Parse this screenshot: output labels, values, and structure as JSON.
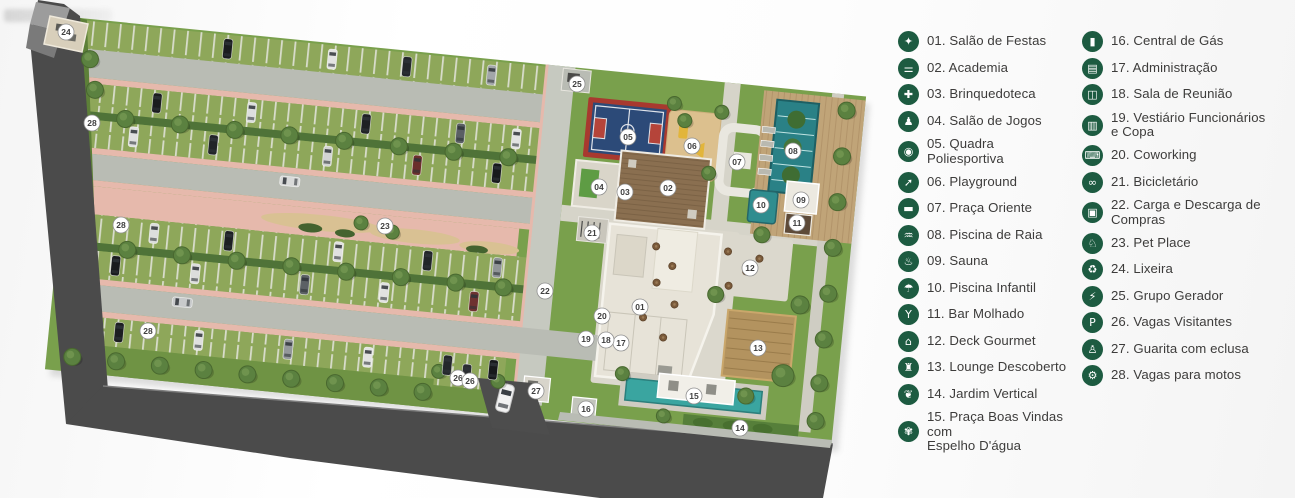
{
  "title": "Implantação / site plan with amenities legend",
  "colors": {
    "accent_green": "#1d5b41",
    "legend_text": "#3d3c3b",
    "grass": "#79a04c",
    "stall_green": "#8ea75a",
    "lane_gray": "#b9bcb4",
    "path_pink": "#e6b9ac",
    "road_dark": "#4b4b4b",
    "pool_teal": "#2a8186",
    "water_mirror_teal": "#3aa5a0",
    "court_blue": "#2c4a78",
    "court_red": "#a8392f",
    "sand": "#dcc08e",
    "wood_deck": "#c0a478",
    "roof_light": "#e7e3d8",
    "roof_wood": "#8a6f50"
  },
  "legend": {
    "columns": [
      {
        "items": [
          {
            "label": "01. Salão de Festas",
            "icon": "balloons",
            "glyph": "✦"
          },
          {
            "label": "02. Academia",
            "icon": "dumbbell",
            "glyph": "⚌"
          },
          {
            "label": "03. Brinquedoteca",
            "icon": "puzzle-piece",
            "glyph": "✚"
          },
          {
            "label": "04. Salão de Jogos",
            "icon": "game-controller",
            "glyph": "♟"
          },
          {
            "label": "05. Quadra Poliesportiva",
            "icon": "sports-court",
            "glyph": "◉"
          },
          {
            "label": "06. Playground",
            "icon": "slide",
            "glyph": "➚"
          },
          {
            "label": "07. Praça Oriente",
            "icon": "bench",
            "glyph": "▬"
          },
          {
            "label": "08. Piscina de Raia",
            "icon": "swimmer",
            "glyph": "♒"
          },
          {
            "label": "09. Sauna",
            "icon": "steam",
            "glyph": "♨"
          },
          {
            "label": "10. Piscina Infantil",
            "icon": "kids-pool",
            "glyph": "☂"
          },
          {
            "label": "11. Bar Molhado",
            "icon": "cocktail-glass",
            "glyph": "Y"
          },
          {
            "label": "12. Deck Gourmet",
            "icon": "house",
            "glyph": "⌂"
          },
          {
            "label": "13. Lounge Descoberto",
            "icon": "pergola",
            "glyph": "♜"
          },
          {
            "label": "14. Jardim Vertical",
            "icon": "plant",
            "glyph": "❦"
          },
          {
            "label": "15. Praça Boas Vindas com\nEspelho D'água",
            "icon": "fountain",
            "glyph": "✾"
          }
        ]
      },
      {
        "items": [
          {
            "label": "16. Central de Gás",
            "icon": "gas-cylinder",
            "glyph": "▮"
          },
          {
            "label": "17. Administração",
            "icon": "briefcase",
            "glyph": "▤"
          },
          {
            "label": "18. Sala de Reunião",
            "icon": "meeting-table",
            "glyph": "◫"
          },
          {
            "label": "19. Vestiário Funcionários\ne Copa",
            "icon": "lockers",
            "glyph": "▥"
          },
          {
            "label": "20. Coworking",
            "icon": "laptop",
            "glyph": "⌨"
          },
          {
            "label": "21. Bicicletário",
            "icon": "bicycle",
            "glyph": "∞"
          },
          {
            "label": "22. Carga e Descarga de Compras",
            "icon": "shopping-cart",
            "glyph": "▣"
          },
          {
            "label": "23. Pet Place",
            "icon": "dog",
            "glyph": "♘"
          },
          {
            "label": "24. Lixeira",
            "icon": "trash-bin",
            "glyph": "♻"
          },
          {
            "label": "25. Grupo Gerador",
            "icon": "generator",
            "glyph": "⚡"
          },
          {
            "label": "26. Vagas Visitantes",
            "icon": "car",
            "glyph": "P"
          },
          {
            "label": "27. Guarita com eclusa",
            "icon": "guard",
            "glyph": "♙"
          },
          {
            "label": "28. Vagas para motos",
            "icon": "motorcycle",
            "glyph": "⚙"
          }
        ]
      }
    ]
  },
  "plan": {
    "markers": [
      {
        "n": "01",
        "x": 640,
        "y": 307
      },
      {
        "n": "02",
        "x": 668,
        "y": 188
      },
      {
        "n": "03",
        "x": 625,
        "y": 192
      },
      {
        "n": "04",
        "x": 599,
        "y": 187
      },
      {
        "n": "05",
        "x": 628,
        "y": 137
      },
      {
        "n": "06",
        "x": 692,
        "y": 146
      },
      {
        "n": "07",
        "x": 737,
        "y": 162
      },
      {
        "n": "08",
        "x": 793,
        "y": 151
      },
      {
        "n": "09",
        "x": 801,
        "y": 200
      },
      {
        "n": "10",
        "x": 761,
        "y": 205
      },
      {
        "n": "11",
        "x": 797,
        "y": 223
      },
      {
        "n": "12",
        "x": 750,
        "y": 268
      },
      {
        "n": "13",
        "x": 758,
        "y": 348
      },
      {
        "n": "14",
        "x": 740,
        "y": 428
      },
      {
        "n": "15",
        "x": 694,
        "y": 396
      },
      {
        "n": "16",
        "x": 586,
        "y": 409
      },
      {
        "n": "17",
        "x": 621,
        "y": 343
      },
      {
        "n": "18",
        "x": 606,
        "y": 340
      },
      {
        "n": "19",
        "x": 586,
        "y": 339
      },
      {
        "n": "20",
        "x": 602,
        "y": 316
      },
      {
        "n": "21",
        "x": 592,
        "y": 233
      },
      {
        "n": "22",
        "x": 545,
        "y": 291
      },
      {
        "n": "23",
        "x": 385,
        "y": 226
      },
      {
        "n": "24",
        "x": 66,
        "y": 32
      },
      {
        "n": "25",
        "x": 577,
        "y": 84
      },
      {
        "n": "26",
        "x": 458,
        "y": 378
      },
      {
        "n": "26",
        "x": 470,
        "y": 381
      },
      {
        "n": "27",
        "x": 536,
        "y": 391
      },
      {
        "n": "28",
        "x": 92,
        "y": 123
      },
      {
        "n": "28",
        "x": 121,
        "y": 225
      },
      {
        "n": "28",
        "x": 148,
        "y": 331
      }
    ]
  }
}
